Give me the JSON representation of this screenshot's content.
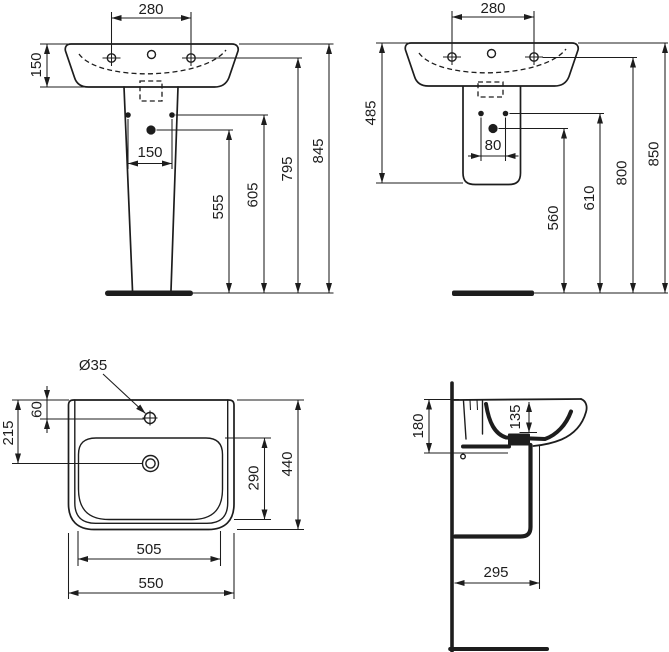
{
  "views": {
    "front_pedestal": {
      "tap_centres": "280",
      "rim_depth": "150",
      "fixing_centres": "150",
      "outlet_height": "555",
      "fixing_height": "605",
      "taphole_height": "795",
      "overall_height": "845"
    },
    "front_semi_pedestal": {
      "tap_centres": "280",
      "basin_semi_height": "485",
      "fixing_centres": "80",
      "outlet_height": "560",
      "fixing_height": "610",
      "taphole_height": "800",
      "overall_height": "850"
    },
    "plan": {
      "taphole_diameter": "Ø35",
      "taphole_offset": "60",
      "outlet_offset": "215",
      "bowl_depth": "290",
      "overall_depth": "440",
      "bowl_width": "505",
      "overall_width": "550"
    },
    "side_section": {
      "apron_height": "180",
      "bowl_inner_depth": "135",
      "projection": "295"
    }
  }
}
